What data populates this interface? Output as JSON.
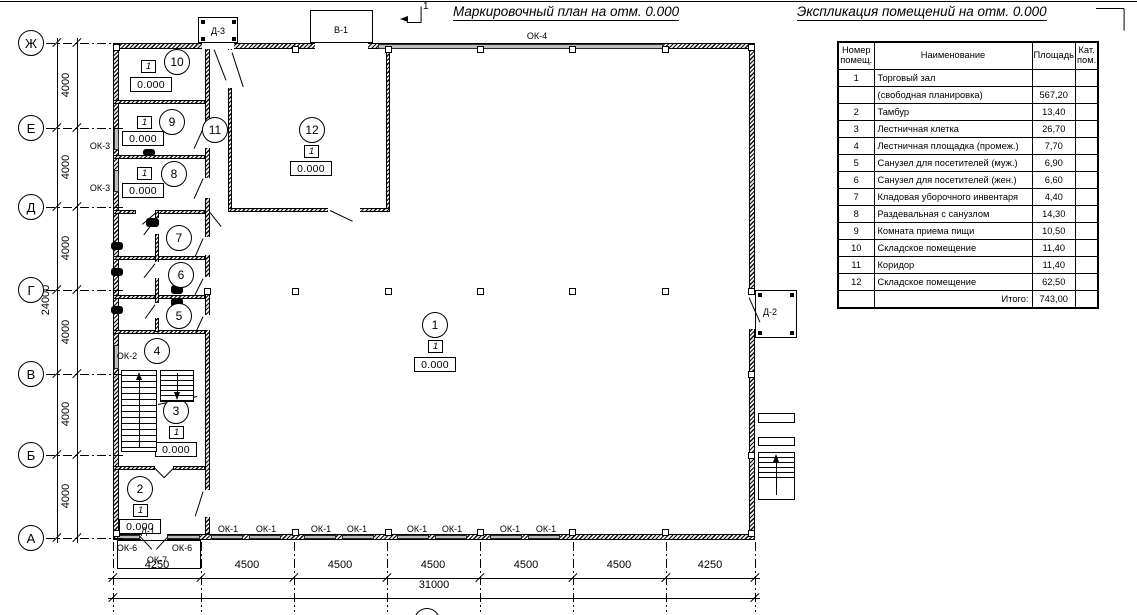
{
  "titles": {
    "plan_title": "Маркировочный план на отм. 0.000",
    "explication_title": "Экспликация помещений на отм. 0.000",
    "section_mark": "1",
    "bottom_axis_mark": "1"
  },
  "explication_table": {
    "headers": {
      "num": "Номер\nпомещ.",
      "name": "Наименование",
      "area": "Площадь",
      "cat": "Кат.\nпом."
    },
    "rows": [
      {
        "num": "1",
        "name": "Торговый зал",
        "area": "",
        "cat": ""
      },
      {
        "num": "",
        "name": "(свободная планировка)",
        "area": "567,20",
        "cat": ""
      },
      {
        "num": "2",
        "name": "Тамбур",
        "area": "13,40",
        "cat": ""
      },
      {
        "num": "3",
        "name": "Лестничная клетка",
        "area": "26,70",
        "cat": ""
      },
      {
        "num": "4",
        "name": "Лестничная площадка (промеж.)",
        "area": "7,70",
        "cat": ""
      },
      {
        "num": "5",
        "name": "Санузел для посетителей (муж.)",
        "area": "6,90",
        "cat": ""
      },
      {
        "num": "6",
        "name": "Санузел для посетителей (жен.)",
        "area": "6,60",
        "cat": ""
      },
      {
        "num": "7",
        "name": "Кладовая уборочного инвентаря",
        "area": "4,40",
        "cat": ""
      },
      {
        "num": "8",
        "name": "Раздевальная с санузлом",
        "area": "14,30",
        "cat": ""
      },
      {
        "num": "9",
        "name": "Комната приема пищи",
        "area": "10,50",
        "cat": ""
      },
      {
        "num": "10",
        "name": "Складское помещение",
        "area": "11,40",
        "cat": ""
      },
      {
        "num": "11",
        "name": "Коридор",
        "area": "11,40",
        "cat": ""
      },
      {
        "num": "12",
        "name": "Складское помещение",
        "area": "62,50",
        "cat": ""
      }
    ],
    "total_label": "Итого:",
    "total_value": "743,00"
  },
  "axes": {
    "row_bubbles": [
      {
        "label": "Ж",
        "y": 43
      },
      {
        "label": "Е",
        "y": 128
      },
      {
        "label": "Д",
        "y": 207
      },
      {
        "label": "Г",
        "y": 290
      },
      {
        "label": "В",
        "y": 374
      },
      {
        "label": "Б",
        "y": 455
      },
      {
        "label": "А",
        "y": 538
      }
    ],
    "row_dim_labels": [
      {
        "text": "4000",
        "y": 85
      },
      {
        "text": "4000",
        "y": 167
      },
      {
        "text": "4000",
        "y": 248
      },
      {
        "text": "4000",
        "y": 332
      },
      {
        "text": "4000",
        "y": 414
      },
      {
        "text": "4000",
        "y": 496
      }
    ],
    "row_total": {
      "text": "24000",
      "x": 46,
      "y": 300
    },
    "col_ticks_x": [
      113,
      201,
      294,
      387,
      480,
      573,
      666,
      755
    ],
    "col_dim_labels": [
      {
        "text": "4250",
        "x": 157
      },
      {
        "text": "4500",
        "x": 247
      },
      {
        "text": "4500",
        "x": 340
      },
      {
        "text": "4500",
        "x": 433
      },
      {
        "text": "4500",
        "x": 526
      },
      {
        "text": "4500",
        "x": 619
      },
      {
        "text": "4250",
        "x": 710
      }
    ],
    "col_total": {
      "text": "31000",
      "x": 434,
      "y": 591
    }
  },
  "plan": {
    "room_markers": [
      {
        "num": "1",
        "cx": 435,
        "cy": 325,
        "flag": "1",
        "fx": 428,
        "fy": 340,
        "elev": "0.000",
        "ex": 414,
        "ey": 357
      },
      {
        "num": "2",
        "cx": 140,
        "cy": 489,
        "flag": "1",
        "fx": 133,
        "fy": 504,
        "elev": "0.000",
        "ex": 119,
        "ey": 519
      },
      {
        "num": "3",
        "cx": 176,
        "cy": 411,
        "flag": "1",
        "fx": 169,
        "fy": 426,
        "elev": "0.000",
        "ex": 155,
        "ey": 442
      },
      {
        "num": "4",
        "cx": 157,
        "cy": 351
      },
      {
        "num": "5",
        "cx": 179,
        "cy": 316
      },
      {
        "num": "6",
        "cx": 181,
        "cy": 275
      },
      {
        "num": "7",
        "cx": 179,
        "cy": 238
      },
      {
        "num": "8",
        "cx": 174,
        "cy": 174,
        "flag": "1",
        "fx": 137,
        "fy": 167,
        "elev": "0.000",
        "ex": 122,
        "ey": 183
      },
      {
        "num": "9",
        "cx": 172,
        "cy": 122,
        "flag": "1",
        "fx": 137,
        "fy": 116,
        "elev": "0.000",
        "ex": 122,
        "ey": 131
      },
      {
        "num": "10",
        "cx": 177,
        "cy": 62,
        "flag": "1",
        "fx": 141,
        "fy": 60,
        "elev": "0.000",
        "ex": 130,
        "ey": 77
      },
      {
        "num": "11",
        "cx": 215,
        "cy": 130
      },
      {
        "num": "12",
        "cx": 312,
        "cy": 130,
        "flag": "1",
        "fx": 304,
        "fy": 145,
        "elev": "0.000",
        "ex": 290,
        "ey": 161
      }
    ],
    "labels": [
      {
        "text": "ОК-4",
        "x": 537,
        "y": 36
      },
      {
        "text": "ОК-3",
        "x": 100,
        "y": 146
      },
      {
        "text": "ОК-3",
        "x": 100,
        "y": 188
      },
      {
        "text": "ОК-2",
        "x": 127,
        "y": 356
      },
      {
        "text": "Д-3",
        "x": 218,
        "y": 31
      },
      {
        "text": "В-1",
        "x": 341,
        "y": 30
      },
      {
        "text": "Д-2",
        "x": 770,
        "y": 312
      },
      {
        "text": "Д-1",
        "x": 148,
        "y": 531
      },
      {
        "text": "ОК-6",
        "x": 127,
        "y": 548
      },
      {
        "text": "ОК-6",
        "x": 182,
        "y": 548
      },
      {
        "text": "ОК-7",
        "x": 157,
        "y": 560
      },
      {
        "text": "ОК-1",
        "x": 228,
        "y": 529
      },
      {
        "text": "ОК-1",
        "x": 266,
        "y": 529
      },
      {
        "text": "ОК-1",
        "x": 321,
        "y": 529
      },
      {
        "text": "ОК-1",
        "x": 357,
        "y": 529
      },
      {
        "text": "ОК-1",
        "x": 417,
        "y": 529
      },
      {
        "text": "ОК-1",
        "x": 452,
        "y": 529
      },
      {
        "text": "ОК-1",
        "x": 510,
        "y": 529
      },
      {
        "text": "ОК-1",
        "x": 546,
        "y": 529
      }
    ],
    "geometry": {
      "walls": [
        [
          113,
          43,
          6,
          497
        ],
        [
          113,
          43,
          642,
          6
        ],
        [
          749,
          43,
          6,
          497
        ],
        [
          113,
          534,
          642,
          6
        ],
        [
          205,
          43,
          5,
          491
        ],
        [
          228,
          48,
          4,
          164
        ],
        [
          386,
          48,
          4,
          164
        ],
        [
          228,
          208,
          162,
          4
        ],
        [
          113,
          100,
          92,
          4
        ],
        [
          113,
          155,
          92,
          4
        ],
        [
          113,
          210,
          23,
          4
        ],
        [
          158,
          210,
          47,
          4
        ],
        [
          113,
          256,
          92,
          4
        ],
        [
          113,
          295,
          92,
          4
        ],
        [
          113,
          330,
          92,
          4
        ],
        [
          155,
          210,
          4,
          122
        ],
        [
          113,
          466,
          42,
          4
        ],
        [
          173,
          466,
          32,
          4
        ]
      ],
      "gaps": [
        [
          202,
          43,
          32,
          6
        ],
        [
          315,
          43,
          53,
          6
        ],
        [
          749,
          295,
          6,
          34
        ],
        [
          141,
          534,
          26,
          6
        ],
        [
          205,
          128,
          5,
          20
        ],
        [
          205,
          178,
          5,
          20
        ],
        [
          205,
          237,
          5,
          18
        ],
        [
          205,
          277,
          5,
          16
        ],
        [
          205,
          315,
          5,
          15
        ],
        [
          205,
          490,
          5,
          27
        ],
        [
          228,
          50,
          4,
          38
        ],
        [
          328,
          208,
          32,
          4
        ],
        [
          155,
          218,
          4,
          16
        ],
        [
          155,
          262,
          4,
          16
        ],
        [
          155,
          303,
          4,
          15
        ]
      ],
      "windows": [
        [
          378,
          43.5,
          285,
          5
        ],
        [
          113.5,
          128,
          5,
          22
        ],
        [
          113.5,
          170,
          5,
          22
        ],
        [
          113.5,
          345,
          5,
          24
        ],
        [
          117,
          535,
          23,
          4
        ],
        [
          167,
          535,
          33,
          4
        ],
        [
          211,
          535,
          32,
          4
        ],
        [
          249,
          535,
          32,
          4
        ],
        [
          304,
          535,
          32,
          4
        ],
        [
          342,
          535,
          32,
          4
        ],
        [
          397,
          535,
          32,
          4
        ],
        [
          435,
          535,
          32,
          4
        ],
        [
          490,
          535,
          32,
          4
        ],
        [
          528,
          535,
          32,
          4
        ]
      ],
      "columns": [
        [
          295,
          49
        ],
        [
          388,
          49
        ],
        [
          480,
          49
        ],
        [
          572,
          49
        ],
        [
          665,
          49
        ],
        [
          295,
          291
        ],
        [
          388,
          291
        ],
        [
          480,
          291
        ],
        [
          572,
          291
        ],
        [
          665,
          291
        ],
        [
          207,
          291
        ],
        [
          751,
          291
        ],
        [
          295,
          532
        ],
        [
          388,
          532
        ],
        [
          480,
          532
        ],
        [
          572,
          532
        ],
        [
          665,
          532
        ],
        [
          116,
          47
        ],
        [
          751,
          47
        ],
        [
          116,
          533
        ],
        [
          751,
          533
        ],
        [
          751,
          374
        ],
        [
          751,
          455
        ]
      ],
      "boxes": [
        [
          198,
          17,
          40,
          26
        ],
        [
          310,
          10,
          63,
          33
        ],
        [
          755,
          290,
          42,
          48
        ],
        [
          117,
          540,
          84,
          29
        ],
        [
          758,
          413,
          37,
          10
        ],
        [
          758,
          437,
          37,
          9
        ],
        [
          758,
          452,
          37,
          48
        ]
      ],
      "dots": [
        [
          201,
          20
        ],
        [
          232,
          20
        ],
        [
          201,
          37
        ],
        [
          232,
          37
        ],
        [
          758,
          293
        ],
        [
          790,
          293
        ],
        [
          758,
          331
        ],
        [
          790,
          331
        ]
      ],
      "segs": [
        [
          214,
          49,
          226,
          80
        ],
        [
          232,
          52,
          243,
          86
        ],
        [
          203,
          128,
          194,
          148
        ],
        [
          203,
          178,
          194,
          198
        ],
        [
          210,
          212,
          221,
          226
        ],
        [
          156,
          212,
          142,
          224
        ],
        [
          155,
          219,
          144,
          234
        ],
        [
          155,
          263,
          144,
          277
        ],
        [
          155,
          304,
          145,
          318
        ],
        [
          203,
          238,
          195,
          256
        ],
        [
          203,
          278,
          195,
          294
        ],
        [
          203,
          316,
          196,
          331
        ],
        [
          330,
          210,
          353,
          221
        ],
        [
          155,
          468,
          164,
          477
        ],
        [
          173,
          468,
          164,
          477
        ],
        [
          203,
          491,
          195,
          516
        ],
        [
          141,
          537,
          152,
          549
        ],
        [
          167,
          537,
          156,
          549
        ],
        [
          749,
          297,
          760,
          322
        ],
        [
          158,
          404,
          197,
          396
        ],
        [
          421,
          6,
          421,
          22
        ],
        [
          407,
          22,
          421,
          22
        ],
        [
          1096,
          8,
          1124,
          8
        ],
        [
          1124,
          8,
          1124,
          30
        ],
        [
          0,
          1,
          1137,
          1
        ]
      ],
      "dashdot_h": [
        [
          46,
          43,
          79
        ],
        [
          46,
          128,
          79
        ],
        [
          46,
          207,
          79
        ],
        [
          46,
          290,
          79
        ],
        [
          46,
          374,
          79
        ],
        [
          46,
          455,
          79
        ],
        [
          46,
          538,
          79
        ]
      ],
      "dashdot_v_x": [
        113,
        201,
        294,
        387,
        480,
        573,
        666,
        755
      ],
      "dashdot_v_span": [
        542,
        70
      ],
      "dim_h_lines": [
        [
          108,
          578,
          652
        ],
        [
          108,
          598,
          652
        ]
      ],
      "dim_v_lines": [
        [
          57,
          38,
          505
        ],
        [
          77,
          38,
          505
        ]
      ],
      "fixtures": [
        [
          143,
          149,
          12,
          7
        ],
        [
          146,
          218,
          13,
          9
        ],
        [
          111,
          242,
          12,
          8
        ],
        [
          111,
          268,
          12,
          8
        ],
        [
          111,
          306,
          12,
          8
        ],
        [
          171,
          285,
          12,
          9
        ],
        [
          171,
          298,
          12,
          9
        ]
      ],
      "stairs": {
        "flight_left": {
          "rect": [
            121,
            370,
            36,
            82
          ],
          "tread_step": 6,
          "arrow": "up",
          "arrow_x": 139
        },
        "flight_right": {
          "rect": [
            160,
            370,
            34,
            32
          ],
          "tread_step": 5,
          "arrow": "down",
          "arrow_x": 177
        },
        "ext_stair": {
          "rect": [
            758,
            452,
            37,
            48
          ],
          "tread_step": 5,
          "tread_h": 28,
          "arrow": "up",
          "arrow_x": 776
        }
      },
      "bottom_bubble": [
        414,
        608,
        26,
        26
      ],
      "section_arrow": [
        400,
        19
      ]
    }
  }
}
